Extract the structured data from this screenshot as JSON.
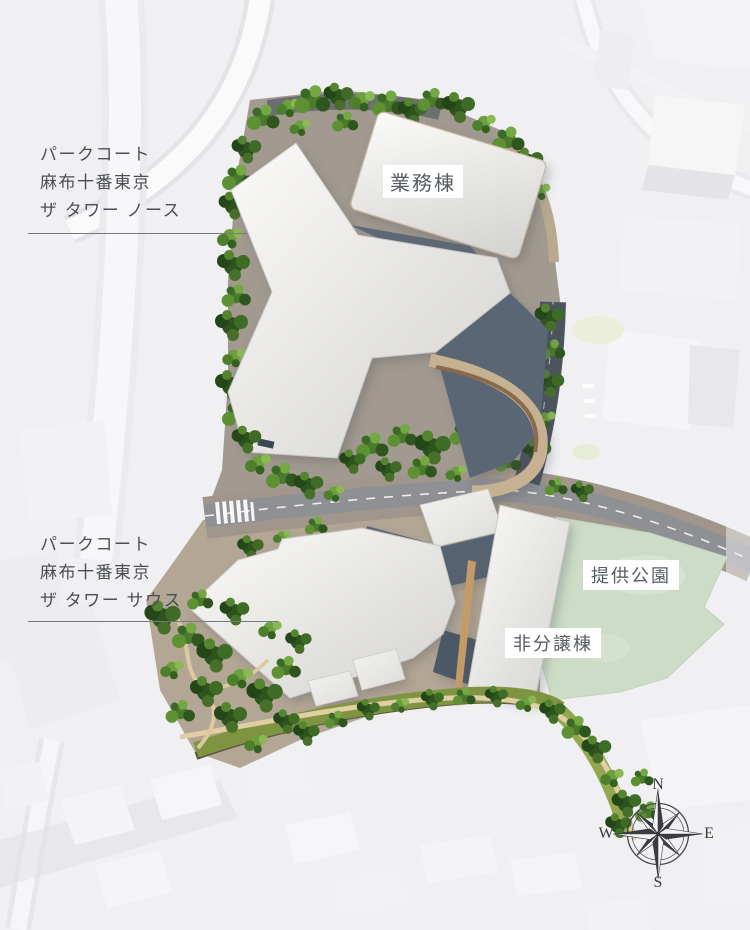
{
  "labels": {
    "north_tower": {
      "line1": "パークコート",
      "line2": "麻布十番東京",
      "line3": "ザ タワー ノース"
    },
    "south_tower": {
      "line1": "パークコート",
      "line2": "麻布十番東京",
      "line3": "ザ タワー サウス"
    },
    "office_building": "業務棟",
    "park": "提供公園",
    "non_sale_building": "非分譲棟"
  },
  "compass": {
    "north": "N",
    "east": "E",
    "south": "S",
    "west": "W"
  },
  "colors": {
    "background": "#f0f0f2",
    "park_green": "#cddcc7",
    "roof_white": "#ebeae7",
    "podium_slate": "#5d6875",
    "road_gray": "#8f9094",
    "dark_road": "#4d545e",
    "tree_dark": "#2d541d",
    "tree_mid": "#4a7a2b",
    "tree_light": "#74a844",
    "path_tan": "#e0cfa5",
    "label_text": "#4b4f55"
  }
}
